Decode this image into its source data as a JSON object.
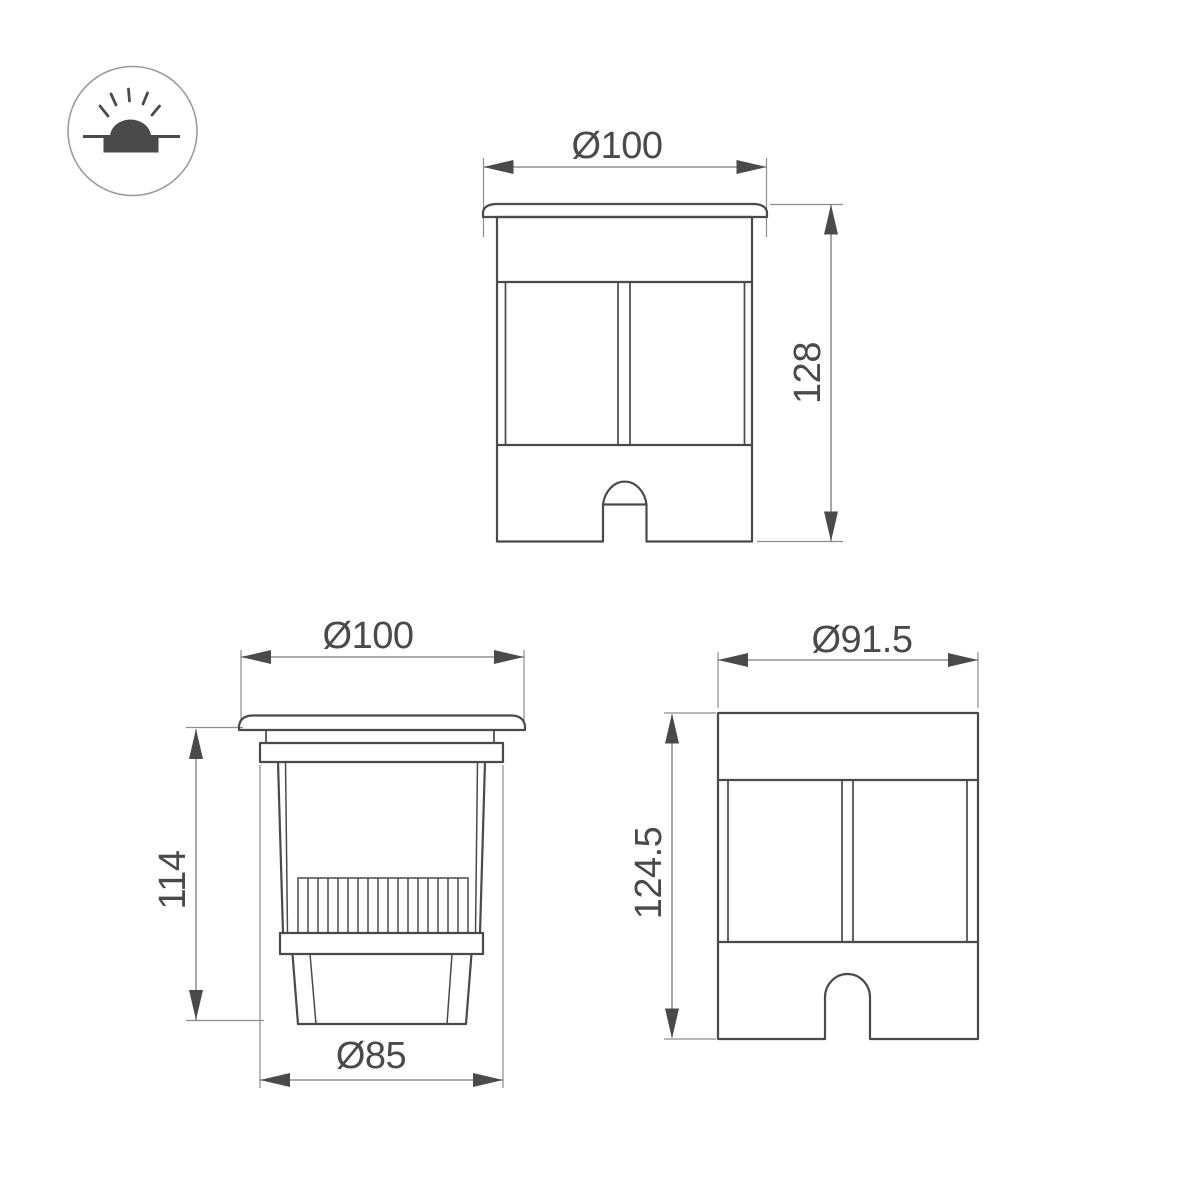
{
  "page": {
    "background": "#ffffff",
    "description_labels": []
  },
  "colors": {
    "part_outline": "#4a4a4a",
    "dimension_line": "#7a7a7a",
    "extension_line": "#8d8d8d",
    "dimension_text": "#4a4a4a",
    "icon_circle_stroke": "#9b9b9b",
    "background": "#ffffff"
  },
  "icons": {
    "product_type": "inground-recessed-light-icon"
  },
  "views": {
    "front": {
      "diameter": "Ø100",
      "height": "128"
    },
    "side": {
      "diameter": "Ø100",
      "height": "114",
      "base_diameter": "Ø85"
    },
    "housing": {
      "diameter": "Ø91.5",
      "height": "124.5"
    }
  }
}
